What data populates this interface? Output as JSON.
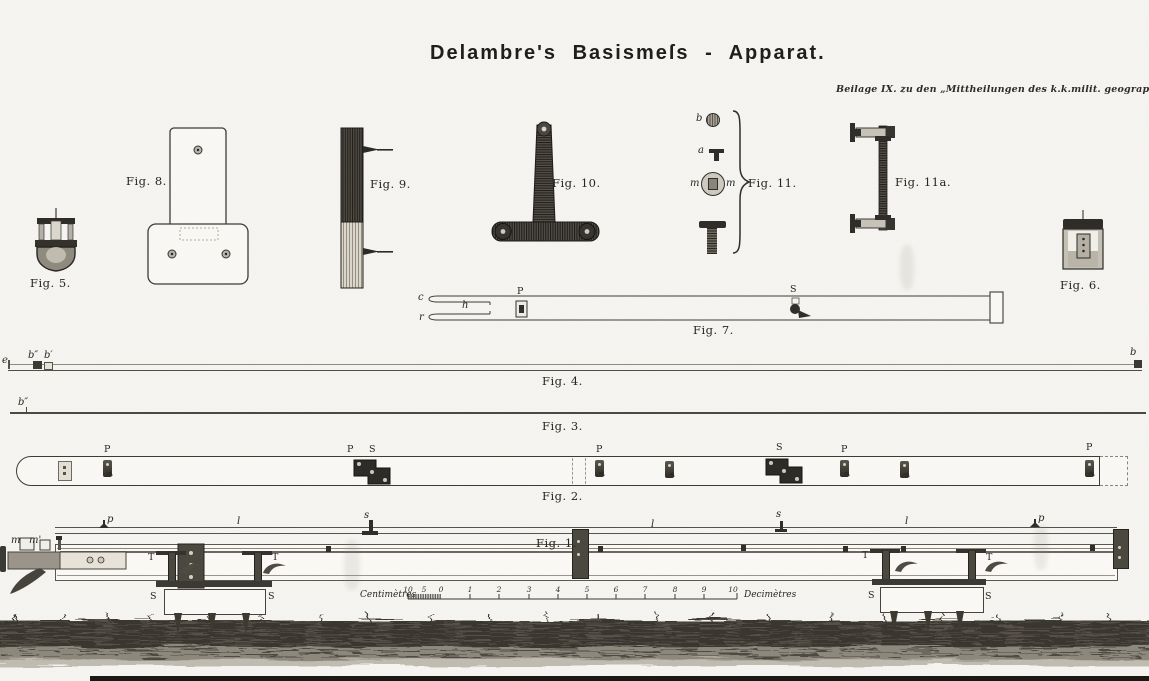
{
  "page": {
    "title": "Delambre's Basismeſs - Apparat.",
    "attribution": "Beilage IX. zu den „Mittheilungen des k.k.milit. geograph. Institutes.“ Band VII.1887."
  },
  "fig5": {
    "label": "Fig. 5."
  },
  "fig6": {
    "label": "Fig. 6."
  },
  "fig8": {
    "label": "Fig. 8."
  },
  "fig9": {
    "label": "Fig. 9."
  },
  "fig10": {
    "label": "Fig. 10."
  },
  "fig11": {
    "label": "Fig. 11.",
    "part_b": "b",
    "part_a": "a",
    "part_m_left": "m",
    "part_m_right": "m"
  },
  "fig11a": {
    "label": "Fig. 11a."
  },
  "fig7": {
    "label": "Fig. 7.",
    "c": "c",
    "h": "h",
    "r": "r",
    "p": "P",
    "a": "a",
    "s": "S"
  },
  "fig4": {
    "label": "Fig. 4.",
    "far_left": "e",
    "b_dprime": "b″",
    "b_prime": "b′",
    "b_right": "b"
  },
  "fig3": {
    "label": "Fig. 3.",
    "b_left": "b″"
  },
  "fig2": {
    "label": "Fig. 2.",
    "m1": "P",
    "m2": "P",
    "m3": "S",
    "m4": "P",
    "m5": "S",
    "m6": "P",
    "m7": "P"
  },
  "fig1": {
    "label": "Fig. 1.",
    "m": "m",
    "m_prime": "m'",
    "p_left": "p",
    "p_right": "p",
    "l_left": "l",
    "l_mid": "l",
    "l_right": "l",
    "s_left": "s",
    "s_right": "s",
    "t_l1": "T",
    "t_l2": "T",
    "t_r1": "T",
    "t_r2": "T",
    "s_l1": "S",
    "s_l2": "S",
    "s_r1": "S",
    "s_r2": "S"
  },
  "scale": {
    "cm_label": "Centimètres",
    "dm_label": "Decimètres",
    "cm": [
      "10",
      "5",
      "0"
    ],
    "dm": [
      "1",
      "2",
      "3",
      "4",
      "5",
      "6",
      "7",
      "8",
      "9",
      "10"
    ]
  }
}
